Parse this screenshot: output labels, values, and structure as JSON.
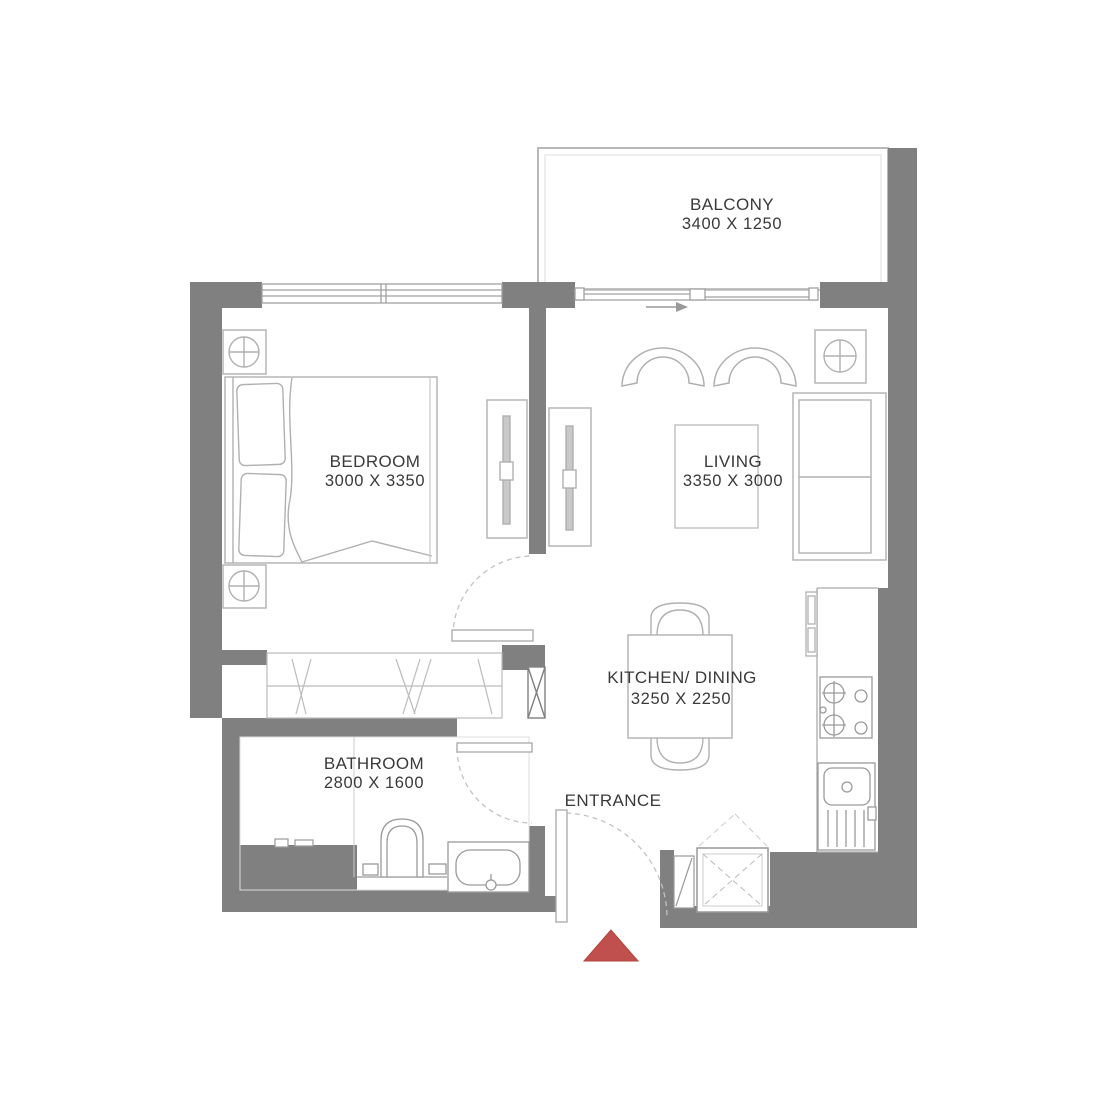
{
  "rooms": [
    {
      "id": "balcony",
      "label": "BALCONY",
      "dimensions": "3400 X 1250"
    },
    {
      "id": "bedroom",
      "label": "BEDROOM",
      "dimensions": "3000 X 3350"
    },
    {
      "id": "living",
      "label": "LIVING",
      "dimensions": "3350 X 3000"
    },
    {
      "id": "kitchen_dining",
      "label": "KITCHEN/ DINING",
      "dimensions": "3250 X 2250"
    },
    {
      "id": "bathroom",
      "label": "BATHROOM",
      "dimensions": "2800 X 1600"
    },
    {
      "id": "entrance",
      "label": "ENTRANCE",
      "dimensions": ""
    }
  ],
  "marker": {
    "name": "entry-direction-triangle",
    "color": "#c0504d"
  },
  "colors": {
    "wall": "#808080",
    "furniture_line": "#b0b0b0",
    "fixture_line": "#9a9a9a",
    "text": "#3a3a3a",
    "background": "#ffffff"
  },
  "symbols": [
    "double-bed",
    "nightstand-lamp",
    "sliding-wardrobe",
    "tv-unit",
    "armchair",
    "sofa",
    "side-table-lamp",
    "coffee-table",
    "dining-table",
    "dining-chair",
    "stove-hob",
    "kitchen-sink",
    "tall-kitchen-unit",
    "toilet",
    "bathtub",
    "vanity-fittings",
    "duct-shaft",
    "door-swing",
    "window",
    "sliding-balcony-door",
    "entry-marker"
  ]
}
